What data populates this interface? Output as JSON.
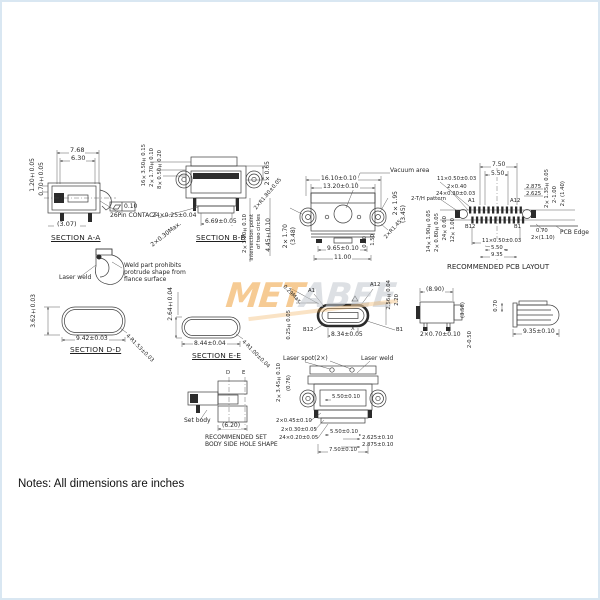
{
  "colors": {
    "line": "#3c3c3c",
    "watermark_orange": "#f0a13e",
    "watermark_gray": "#c3c8ce"
  },
  "note": "Notes: All dimensions are inches",
  "watermark": {
    "left": "MET",
    "right": "ABEE"
  },
  "aa": {
    "title": "SECTION A-A",
    "w1": "7.68",
    "w2": "6.30",
    "w3": "(3.07)",
    "v1": "1.20±0.05",
    "v2": "0.70±0.05",
    "contact": "26Pin CONTACT",
    "flag": "0.10"
  },
  "bb": {
    "title": "SECTION B-B",
    "v1": "16×3.50±0.15",
    "v2": "2×1.70±0.10",
    "v3": "8×0.50±0.20",
    "pins": "24×0.25±0.04",
    "diag": "2×0.30Max.",
    "w": "6.69±0.05",
    "r1": "2×0.65",
    "c1": "2×3.20±0.10",
    "c2": "intersection point",
    "c3": "of two circles",
    "c4": "4.45±0.10"
  },
  "top": {
    "vac": "Vacuum area",
    "w1": "16.10±0.10",
    "w2": "13.20±0.10",
    "lv1": "2×1.70",
    "lv2": "(3.48)",
    "ld": "2×R1.80±0.05",
    "rv1": "2×1.95",
    "rv2": "(3.45)",
    "rd": "2×R1.45",
    "b1": "9.65±0.10",
    "b2": "11.00",
    "s1": "0.40",
    "s2": "1.50"
  },
  "pcb": {
    "title": "RECOMMENDED PCB LAYOUT",
    "t1": "7.50",
    "t2": "5.50",
    "l1": "11×0.50±0.03",
    "l2": "2×0.40",
    "l3": "24×0.30±0.03",
    "l4": "2-T/H pattern",
    "lv1": "14×1.90±0.05",
    "lv2": "2×0.80±0.05",
    "lv3": "24×0.60",
    "lv4": "12×1.00",
    "r1": "2.875",
    "r2": "2.625",
    "rv1": "2×1.35±0.05",
    "rv2": "2-1.00",
    "rv3": "2×(1.40)",
    "a1": "A1",
    "a12": "A12",
    "b12": "B12",
    "b1": "B1",
    "e1": "0.70",
    "e2": "2×(1.10)",
    "edge": "PCB Edge",
    "m1": "11×0.50±0.03",
    "m2": "5.50",
    "m3": "9.35"
  },
  "weld": {
    "laser": "Laser weld",
    "n1": "Weld part prohibits",
    "n2": "protrude shape from",
    "n3": "flance surface"
  },
  "dd": {
    "title": "SECTION D-D",
    "h": "3.62±0.03",
    "w": "9.42±0.03",
    "r": "4-R1.53±0.03"
  },
  "ee": {
    "title": "SECTION E-E",
    "h": "2.64±0.04",
    "w": "8.44±0.04",
    "r": "4-R1.00±0.04"
  },
  "face": {
    "a1": "A1",
    "a12": "A12",
    "b12": "B12",
    "b1": "B1",
    "x": "X",
    "w": "8.34±0.05",
    "r1": "2.56±0.04",
    "r2": "2.20",
    "l1": "0.25±0.05",
    "d1": "0.29Max."
  },
  "sv1": {
    "t": "(8.90)",
    "b": "2×0.70±0.10",
    "r": "(3.58)",
    "bv": "2-0.50"
  },
  "sv2": {
    "l": "0.70",
    "b": "9.35±0.10"
  },
  "bot": {
    "spot": "Laser spot(2×)",
    "weld": "Laser weld",
    "lv1": "2×3.45±0.10",
    "lv2": "(0.76)",
    "m1": "5.50±0.10",
    "p1": "2×0.45±0.10",
    "p2": "2×0.30±0.05",
    "p3": "24×0.20±0.05",
    "m2": "5.50±0.10",
    "r1": "2.625±0.10",
    "r2": "2.875±0.10",
    "b1": "7.50±0.10"
  },
  "set": {
    "body": "Set body",
    "dim": "(6.20)",
    "t1": "RECOMMENDED SET",
    "t2": "BODY SIDE HOLE SHAPE",
    "d": "D",
    "e": "E"
  }
}
